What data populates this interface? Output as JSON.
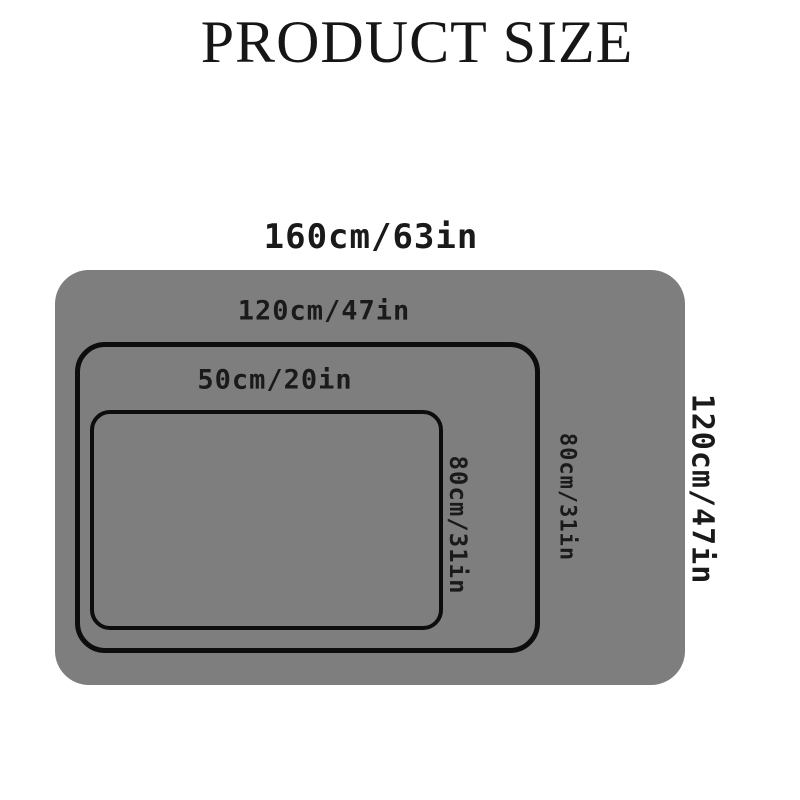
{
  "title": "PRODUCT SIZE",
  "colors": {
    "background": "#ffffff",
    "mat_gray": "#7e7e7e",
    "outline_black": "#0d0d0d",
    "text_black": "#1a1a1a"
  },
  "diagram": {
    "outer": {
      "width_label": "160cm/63in",
      "height_label": "120cm/47in"
    },
    "middle": {
      "width_label": "120cm/47in",
      "height_label": "80cm/31in"
    },
    "inner": {
      "width_label": "50cm/20in",
      "height_label": "80cm/31in"
    }
  }
}
